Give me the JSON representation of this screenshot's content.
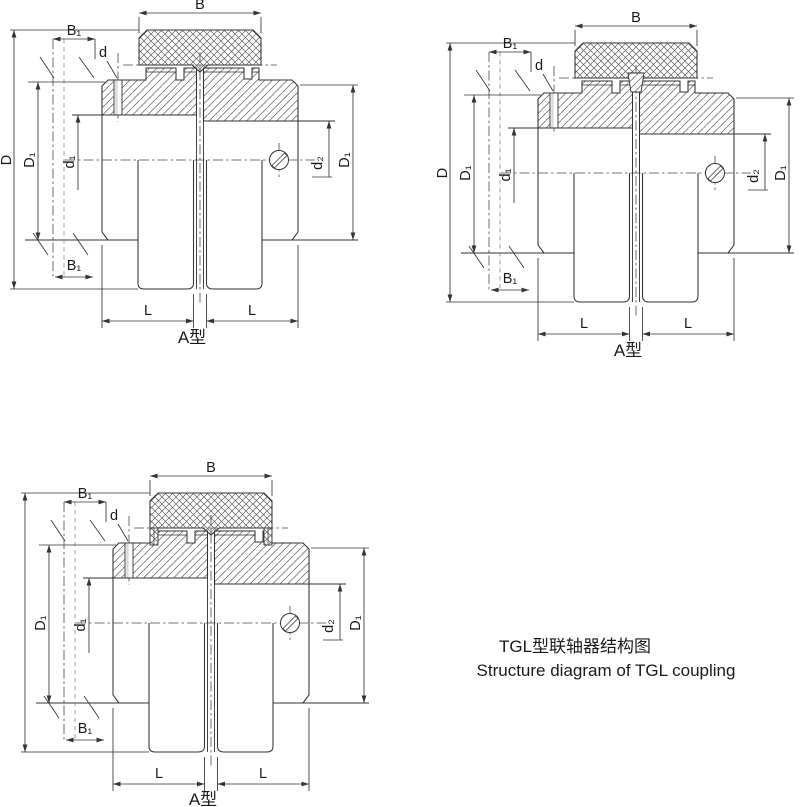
{
  "figure_titles": {
    "zh": "TGL型联轴器结构图",
    "en": "Structure diagram of TGL coupling"
  },
  "colors": {
    "line": "#333333",
    "background": "#ffffff"
  },
  "diagrams": [
    {
      "position": "top-left",
      "variant": "plain-sleeve",
      "caption": "A型",
      "labels": {
        "B": "B",
        "B1_top": "B₁",
        "d": "d",
        "D": "D",
        "D1_left": "D₁",
        "d1": "d₁",
        "d2": "d₂",
        "D1_right": "D₁",
        "B1_bottom": "B₁",
        "L_left": "L",
        "L_right": "L"
      }
    },
    {
      "position": "top-right",
      "variant": "center-pin",
      "caption": "A型",
      "labels": {
        "B": "B",
        "B1_top": "B₁",
        "d": "d",
        "D": "D",
        "D1_left": "D₁",
        "d1": "d₁",
        "d2": "d₂",
        "D1_right": "D₁",
        "B1_bottom": "B₁",
        "L_left": "L",
        "L_right": "L"
      }
    },
    {
      "position": "bottom-left",
      "variant": "side-lugs",
      "caption": "A型",
      "labels": {
        "B": "B",
        "B1_top": "B₁",
        "d": "d",
        "D1_left": "D₁",
        "d1": "d₁",
        "d2": "d₂",
        "D1_right": "D₁",
        "B1_bottom": "B₁",
        "L_left": "L",
        "L_right": "L"
      }
    }
  ]
}
